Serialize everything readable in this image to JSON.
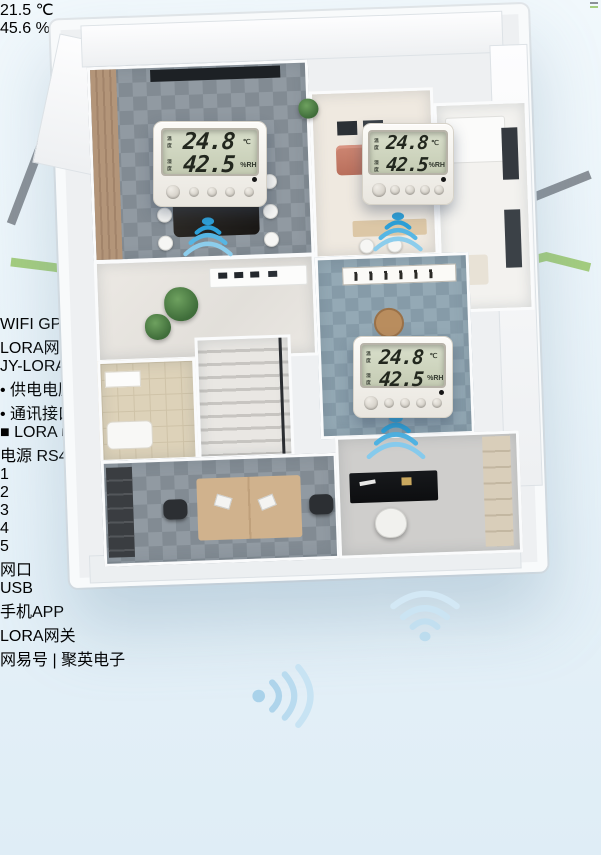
{
  "sensors": [
    {
      "temp_label": "温度",
      "temp": "24.8",
      "temp_unit": "℃",
      "hum_label": "湿度",
      "hum": "42.5",
      "hum_unit": "%RH"
    },
    {
      "temp_label": "温度",
      "temp": "24.8",
      "temp_unit": "℃",
      "hum_label": "湿度",
      "hum": "42.5",
      "hum_unit": "%RH"
    },
    {
      "temp_label": "温度",
      "temp": "24.8",
      "temp_unit": "℃",
      "hum_label": "湿度",
      "hum": "42.5",
      "hum_unit": "%RH"
    }
  ],
  "phone": {
    "lcd_temp": "21.5",
    "lcd_temp_unit": "℃",
    "lcd_hum": "45.6",
    "lcd_hum_unit": "%"
  },
  "gateway": {
    "title": "LORA网关",
    "model": "JY-LORA1000",
    "antennas": [
      "WIFI",
      "GPRS",
      "LORA"
    ],
    "specs": [
      "• 供电电压：DC 7-30V",
      "• 通讯接口：■ RS485  ■ 网口  ■ WIFI",
      "■ LORA  ■ GPRS  ■ USB"
    ],
    "ports": {
      "power": "电源",
      "rs485": "RS485",
      "pins": "+ -  PB A+ B-",
      "eth": "网口",
      "usb": "USB"
    },
    "terminals": [
      "1",
      "2",
      "3",
      "4",
      "5"
    ]
  },
  "captions": {
    "phone": "手机APP",
    "gateway": "LORA网关"
  },
  "watermark": {
    "brand": "网易号",
    "divider": "|",
    "name": "聚英电子"
  },
  "colors": {
    "wifi_blue": "#2da0d8",
    "wifi_pale": "#c9e4f3",
    "gateway_navy": "#1a2647",
    "gateway_panel": "#2847ab",
    "stripe_red": "#d8472b",
    "antenna_red": "#b2271c",
    "lcd_green": "#ccd3bd",
    "sofa_salmon": "#c8806e"
  }
}
